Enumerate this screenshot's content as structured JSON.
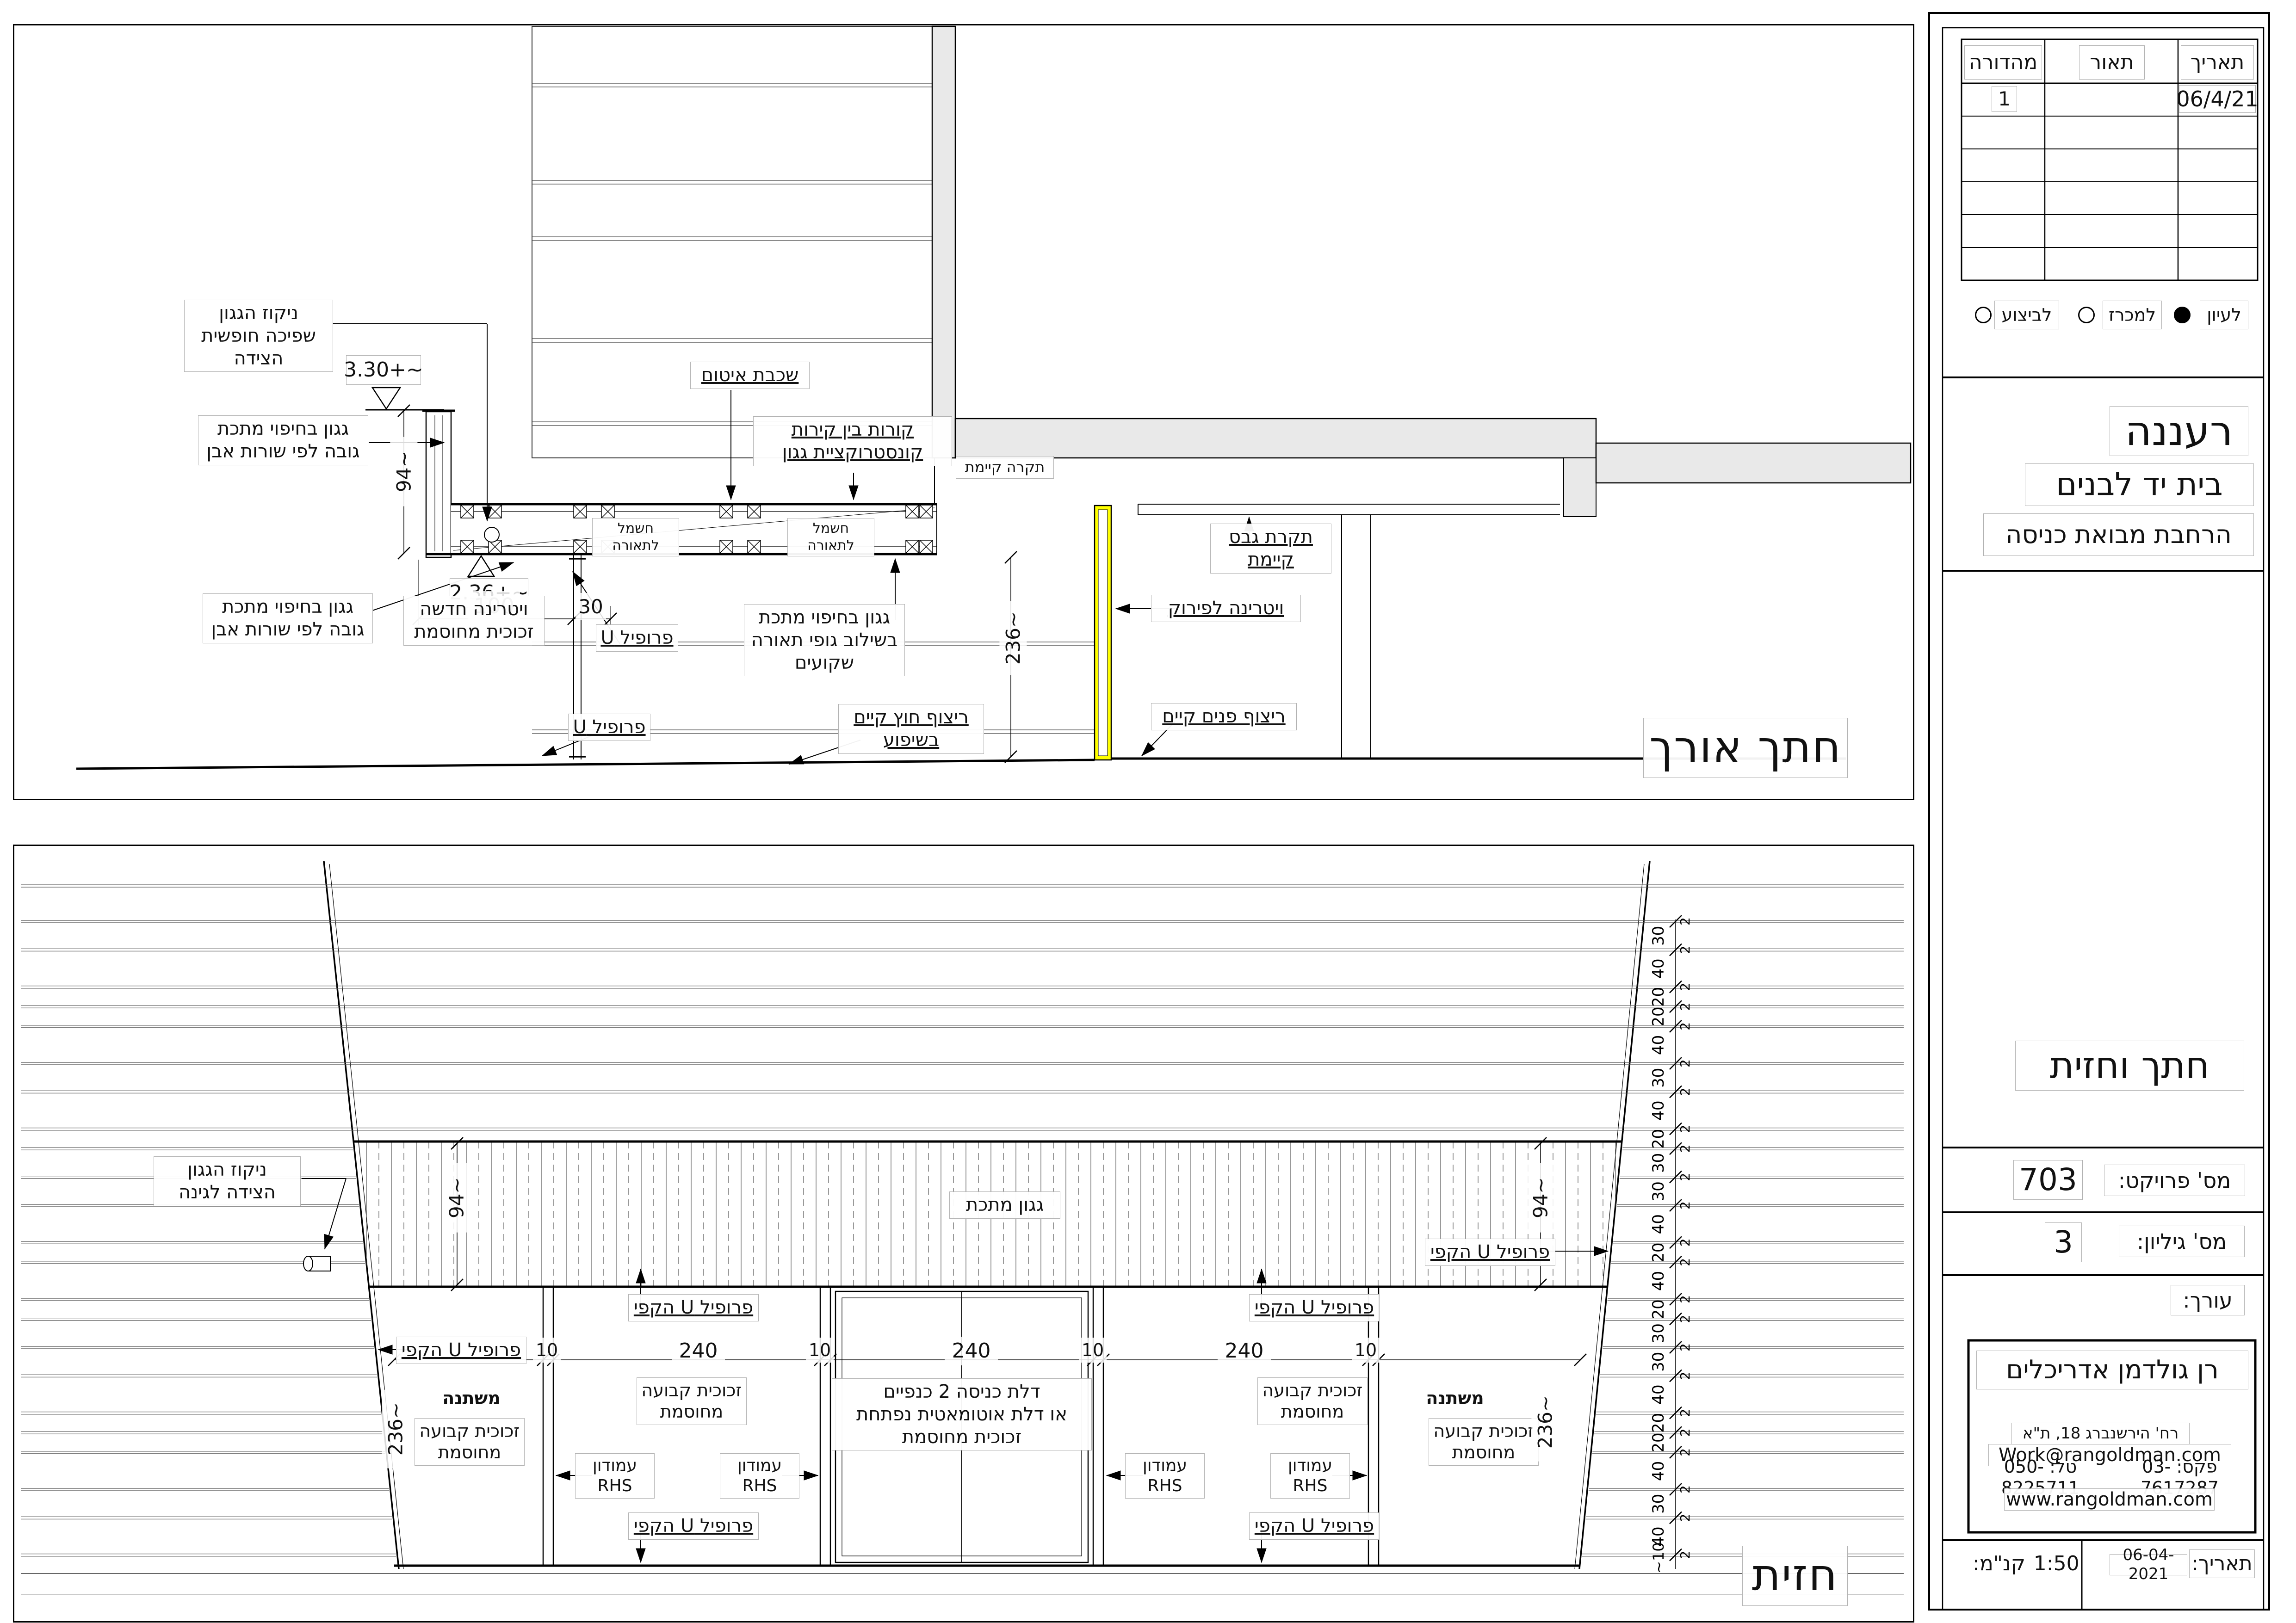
{
  "sheet": {
    "caption_section": "חתך אורך",
    "caption_facade": "חזית"
  },
  "titleblock": {
    "revision_table": {
      "headers": {
        "date": "תאריך",
        "description": "תאור",
        "edition": "מהדורה"
      },
      "first_row": {
        "date": "06/4/21",
        "description": "",
        "edition": "1"
      },
      "empty_row_count": 5
    },
    "status_options": [
      {
        "label": "לעיון",
        "selected": true
      },
      {
        "label": "למכרז",
        "selected": false
      },
      {
        "label": "לביצוע",
        "selected": false
      }
    ],
    "project": {
      "city": "רעננה",
      "building": "בית יד לבנים",
      "scope": "הרחבת מבואת כניסה"
    },
    "sheet_title": "חתך וחזית",
    "project_number_label": "מס' פרויקט:",
    "project_number": "703",
    "sheet_number_label": "מס' גיליון:",
    "sheet_number": "3",
    "editor_label": "עורך:",
    "firm": {
      "name": "רן גולדמן אדריכלים",
      "address": "רח' הירשנברג 18, ת\"א",
      "email": "Work@rangoldman.com",
      "phone": "טל: 050-8225711",
      "fax": "פקס: 03-7617287",
      "website": "www.rangoldman.com"
    },
    "date_label": "תאריך:",
    "date": "06-04-2021",
    "scale_label": "קנ\"מ:",
    "scale": "1:50"
  },
  "section": {
    "labels": {
      "gutter": "ניקוז הגגון\nשפיכה חופשית הצידה",
      "canopy_cladding": "גגון בחיפוי מתכת\nגובה לפי שורות אבן",
      "seal": "שכבת איטום",
      "beams": "קורות בין קירות\nקונסטרוקציית גגון",
      "electric": "חשמל לתאורה",
      "ceiling_existing": "תקרה קיימת",
      "gypsum_ceiling": "תקרת גבס\nקיימת",
      "vitrine_new": "ויטרינה חדשה\nזכוכית מחוסמת",
      "u_profile": "פרופיל U",
      "vitrine_demolish": "ויטרינה לפירוק",
      "canopy_lighting": "גגון בחיפוי מתכת\nבשילוב גופי תאורה\nשקועים",
      "floor_exterior": "ריצוף חוץ קיים\nבשיפוע",
      "floor_interior": "ריצוף פנים קיים"
    },
    "levels": {
      "top": "~+3.30",
      "bottom": "~+2.36"
    },
    "dims": {
      "fascia_height": "~94",
      "d100": "100",
      "d30": "30",
      "clear_height": "~236"
    }
  },
  "facade": {
    "labels": {
      "gutter": "ניקוז הגגון\nהצידה לגינה",
      "canopy": "גגון מתכת",
      "u_perimeter": "פרופיל U הקפי",
      "glass_fixed": "זכוכית קבועה\nמחוסמת",
      "door": "דלת כניסה 2 כנפיים\nאו דלת אוטומאטית נפתחת\nזכוכית מחוסמת",
      "column_rhs": "עמודון\nRHS",
      "variable": "משתנה"
    },
    "dims": {
      "fascia_height": "~94",
      "glass_height": "~236",
      "bay": "240",
      "mullion": "10",
      "joint": "2",
      "bottom": "~10"
    },
    "stone_courses": [
      30,
      40,
      20,
      20,
      40,
      30,
      40,
      20,
      30,
      30,
      40,
      20,
      40,
      20,
      30,
      30,
      40,
      20,
      20,
      40,
      30,
      40,
      30
    ]
  },
  "colors": {
    "highlight": "#ffff00",
    "concrete": "#e9e9e9",
    "line": "#000000"
  }
}
